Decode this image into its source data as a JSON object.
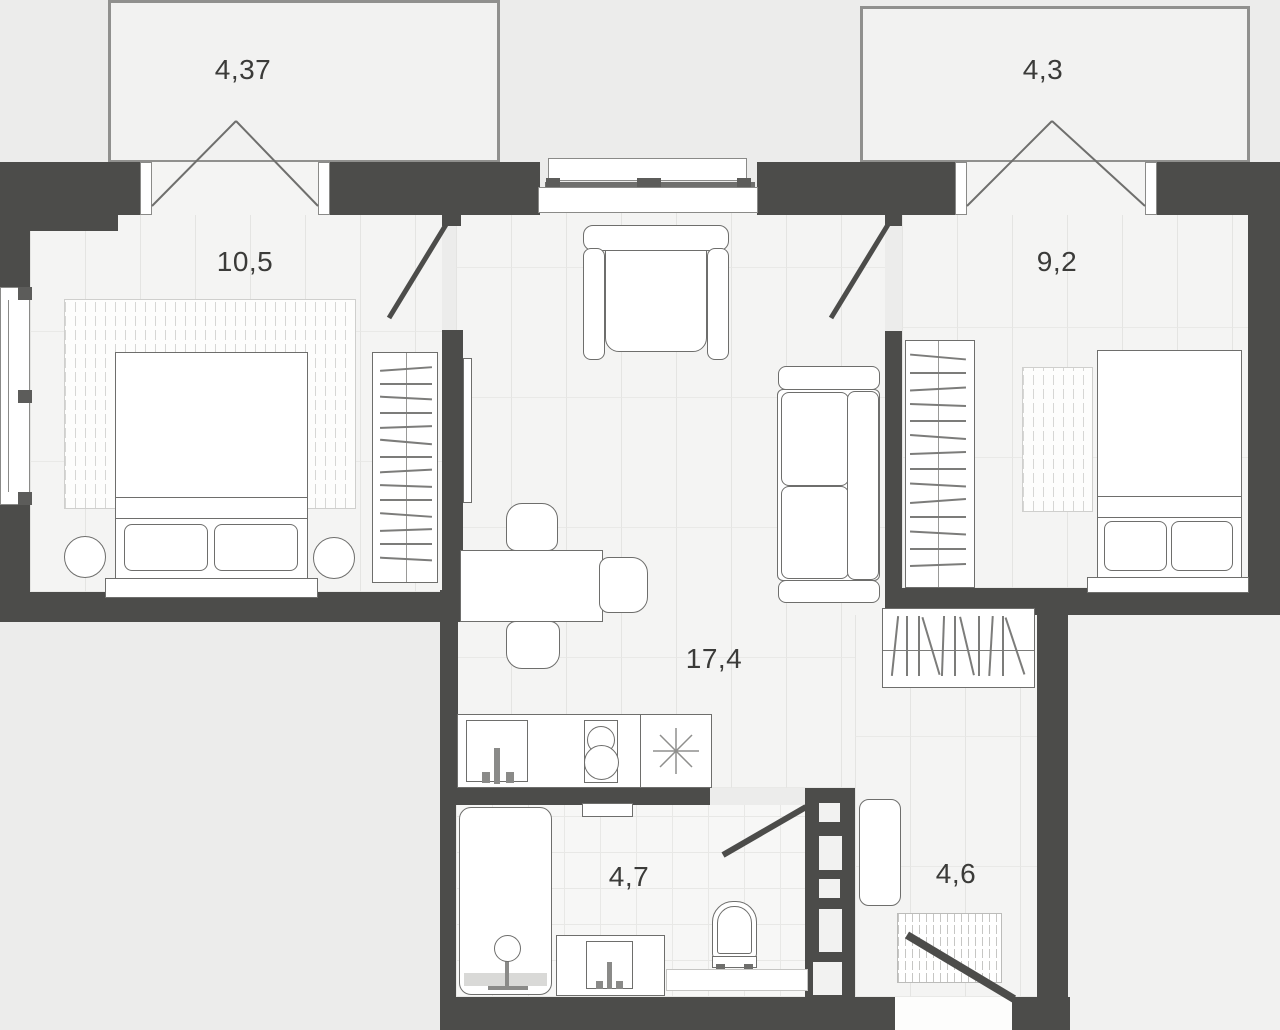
{
  "rooms": [
    {
      "name": "balcony-left",
      "area": "4,37"
    },
    {
      "name": "bedroom-left",
      "area": "10,5"
    },
    {
      "name": "living-kitchen",
      "area": "17,4"
    },
    {
      "name": "bathroom",
      "area": "4,7"
    },
    {
      "name": "hallway",
      "area": "4,6"
    },
    {
      "name": "bedroom-right",
      "area": "9,2"
    },
    {
      "name": "balcony-right",
      "area": "4,3"
    }
  ],
  "colors": {
    "wall": "#4c4c4a",
    "background": "#ececeb",
    "floor": "#f4f4f3",
    "furniture_outline": "#6e6e6c"
  }
}
